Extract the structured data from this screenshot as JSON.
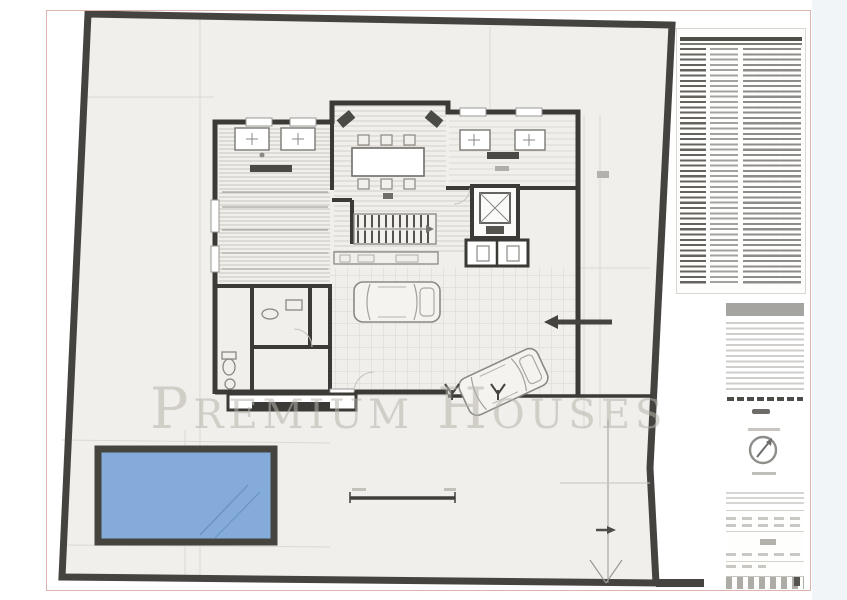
{
  "document": {
    "type": "architectural-floor-plan",
    "watermark_text": "Premium Houses"
  },
  "sheet": {
    "paper_color": "#ffffff",
    "border_color": "#ddb4ae",
    "site_fill": "#f1efeb"
  },
  "plan": {
    "boundary_color": "#45433f",
    "wall_color": "#3b3a36",
    "pool": {
      "fill": "#84abd9",
      "border": "#45443f"
    },
    "floor_hatch_color": "#c7c4be",
    "tile_grid_color": "#d7d4ce"
  },
  "sidebar": {
    "schedule": {
      "approx_rows": 46,
      "header_color": "#504e49",
      "legible": false
    },
    "compass": {
      "needle_direction": "north-east"
    }
  },
  "scale_bar": {
    "present": true
  }
}
